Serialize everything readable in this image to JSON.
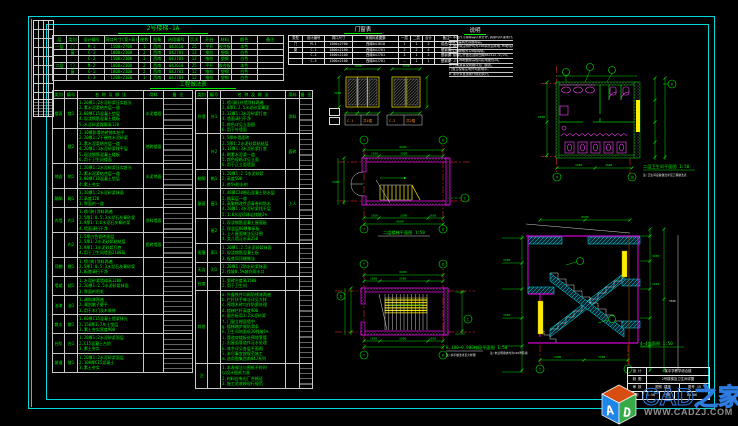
{
  "titles": {
    "schedule": "2号楼梯-1A",
    "materials": "工程做法表",
    "door_window": "门窗表",
    "notes": "说明"
  },
  "labels": {
    "plan1": "二层楼梯平面图 1:50",
    "stair_plan": "8.100~9.900梯段平面图 1:50",
    "stair_plan_note": "注:扶手做法详见大样图",
    "toilet": "二层卫生间平面图 1:50",
    "toilet_note": "注:卫生间设备做法详见工程做法表",
    "section": "4—4剖面图 1:50",
    "section_note": "注:未注明墙体均为240厚砖墙"
  },
  "dims": {
    "a": "6600",
    "b": "3300",
    "c": "1650",
    "d": "1800",
    "e": "1500",
    "f": "2100",
    "g": "1:50",
    "h": "900"
  },
  "bubbles": {
    "n7": "7",
    "n8": "8",
    "n9": "9",
    "n10": "10",
    "c": "C",
    "d": "D",
    "e": "E"
  },
  "schedule_table": {
    "headers": [
      "层",
      "类别",
      "设计编号",
      "洞口尺寸(宽×高)",
      "樘数",
      "图集",
      "选用编号",
      "页次",
      "开启",
      "材料",
      "颜色",
      "备注"
    ],
    "rows": [
      [
        "一层",
        "门",
        "M-1",
        "1500×2700",
        "1",
        "西南",
        "04J610",
        "25",
        "平开",
        "胶合板",
        "本色",
        ""
      ],
      [
        "",
        "窗",
        "C-1",
        "1800×2100",
        "2",
        "西南",
        "04J701",
        "12",
        "推拉",
        "塑钢",
        "白色",
        ""
      ],
      [
        "",
        "",
        "C-2",
        "1500×2100",
        "1",
        "西南",
        "04J701",
        "12",
        "推拉",
        "塑钢",
        "白色",
        ""
      ],
      [
        "二层",
        "门",
        "M-2",
        "1000×2100",
        "2",
        "西南",
        "04J610",
        "25",
        "平开",
        "胶合板",
        "本色",
        ""
      ],
      [
        "",
        "窗",
        "C-1",
        "1800×2100",
        "2",
        "西南",
        "04J701",
        "12",
        "推拉",
        "塑钢",
        "白色",
        ""
      ],
      [
        "",
        "",
        "C-3",
        "1200×2100",
        "1",
        "西南",
        "04J701",
        "12",
        "推拉",
        "塑钢",
        "白色",
        ""
      ]
    ]
  },
  "door_window_table": {
    "headers": [
      "类型",
      "设计编号",
      "洞口尺寸",
      "采用标准图集",
      "一层",
      "二层",
      "合计",
      "备注"
    ],
    "rows": [
      [
        "门",
        "M-1",
        "1500×2700",
        "西南04J610",
        "1",
        "1",
        "2",
        "成品门"
      ],
      [
        "窗",
        "C-1",
        "1800×2100",
        "西南04J701",
        "2",
        "2",
        "4",
        "塑钢窗"
      ],
      [
        "",
        "C-2",
        "1500×2100",
        "西南04J701",
        "1",
        "1",
        "2",
        "塑钢窗"
      ],
      [
        "",
        "C-3",
        "1200×2100",
        "西南04J701",
        "—",
        "1",
        "1",
        "塑钢窗"
      ]
    ]
  },
  "notes": {
    "lines": [
      "1.本图尺寸除标高以米计外,其余均以毫米计。",
      "  标高为建筑完成面标高。",
      "2.墙身除注明外均为240厚页岩砖墙,M5砂浆砌筑。",
      "  卫生间隔墙为120厚砖墙。",
      "3.楼梯栏杆做法选用西南04J412-①/25。",
      "4.卫生间地面标高较同层地面低20。",
      "5.门窗数量及规格详见门窗表。",
      "  门窗立樘除注明外均居墙中。",
      "6.未尽事宜按现行规范执行。"
    ]
  },
  "materials_a": {
    "headers": [
      "类别",
      "编号",
      "名 称 及 做 法",
      "用料",
      "备 注"
    ],
    "groups": [
      {
        "cat": "楼面",
        "code": "楼1",
        "lines": [
          "1.20厚1:2水泥砂浆压实赶光",
          "2.素水泥浆结合层一道",
          "3.60厚C15混凝土垫层",
          "4.现浇钢筋混凝土楼板",
          "5.水泥砂浆踢脚高120"
        ],
        "unit": "水泥楼面"
      },
      {
        "cat": "",
        "code": "楼2",
        "lines": [
          "1.10厚防滑地砖铺实拍平",
          "2.20厚1:2干硬性水泥砂浆",
          "3.素水泥浆结合层一道",
          "4.20厚1:3水泥砂浆找平层",
          "5.现浇钢筋混凝土楼板",
          "6.用于卫生间楼面"
        ],
        "unit": "地砖楼面"
      },
      {
        "cat": "地面",
        "code": "地1",
        "lines": [
          "1.20厚1:2水泥砂浆压实赶光",
          "2.素水泥浆结合层一道",
          "3.80厚C10混凝土垫层",
          "4.素土夯实"
        ],
        "unit": "水泥地面"
      },
      {
        "cat": "踢脚",
        "code": "踢1",
        "lines": [
          "1.20厚1:2水泥砂浆抹面",
          "2.高度120",
          "3.界面剂一道"
        ],
        "unit": ""
      },
      {
        "cat": "内墙",
        "code": "内1",
        "lines": [
          "1.喷(刷)涂料两遍",
          "2.5厚1:0.5:3水泥石灰膏砂浆",
          "3.9厚1:1:6水泥石灰膏砂浆",
          "4.墙面清扫干净"
        ],
        "unit": "涂料墙面"
      },
      {
        "cat": "",
        "code": "内2",
        "lines": [
          "1.5厚白色瓷砖面层",
          "2.5厚1:2水泥砂浆粘结层",
          "3.9厚1:3水泥砂浆打底",
          "4.用于卫生间墙面2100高"
        ],
        "unit": "瓷砖墙面"
      },
      {
        "cat": "顶棚",
        "code": "棚1",
        "lines": [
          "1.喷(刷)涂料两遍",
          "2.5厚1:0.5:3水泥石灰膏砂浆",
          "3.板底清扫干净"
        ],
        "unit": ""
      },
      {
        "cat": "墙裙",
        "code": "裙1",
        "lines": [
          "1.水泥砂浆墙裙高1200",
          "2.20厚1:2.5水泥砂浆抹面",
          "3.界面剂甩毛"
        ],
        "unit": ""
      },
      {
        "cat": "油漆",
        "code": "油1",
        "lines": [
          "1.调和漆两遍",
          "2.满刮腻子磨平",
          "3.用于木门及木装修"
        ],
        "unit": ""
      },
      {
        "cat": "散水",
        "code": "散1",
        "lines": [
          "1.60厚C15混凝土提浆抹光",
          "2.150厚3:7灰土垫层",
          "3.素土夯实宽度900"
        ],
        "unit": ""
      },
      {
        "cat": "台阶",
        "code": "台1",
        "lines": [
          "1.20厚1:2水泥砂浆面层",
          "2.C15混凝土台阶",
          "3.素土夯实"
        ],
        "unit": ""
      },
      {
        "cat": "坡道",
        "code": "坡1",
        "lines": [
          "1.20厚1:2水泥砂浆面层",
          "2.100厚C15混凝土",
          "3.素土夯实"
        ],
        "unit": ""
      }
    ]
  },
  "materials_b": {
    "headers": [
      "类别",
      "编号",
      "名 称 及 做 法",
      "用料",
      "备 注"
    ],
    "groups": [
      {
        "cat": "外墙",
        "code": "外1",
        "lines": [
          "1.喷(刷)外墙涂料两遍",
          "2.6厚1:2.5水泥砂浆罩面",
          "3.12厚1:3水泥砂浆打底",
          "4.墙面清扫干净",
          "5.颜色详见立面图",
          "6.用于外墙面"
        ],
        "unit": "涂料"
      },
      {
        "cat": "",
        "code": "外2",
        "lines": [
          "1.5厚外墙面砖",
          "2.5厚1:2水泥砂浆粘结层",
          "3.12厚1:3水泥砂浆打底",
          "4.刷素水泥浆一道",
          "5.颜色规格详见立面",
          "6.用于正立面墙面"
        ],
        "unit": "面砖"
      },
      {
        "cat": "勒脚",
        "code": "勒1",
        "lines": [
          "1.20厚1:2.5水泥砂浆",
          "2.高度500",
          "3.掺5%防水剂"
        ],
        "unit": ""
      },
      {
        "cat": "屋面",
        "code": "屋1",
        "lines": [
          "1.40厚C20细石混凝土防水层",
          "2.隔离层一道",
          "3.高聚物改性沥青卷材防水",
          "4.20厚1:3水泥砂浆找平层",
          "5.1:8水泥珍珠岩找坡2%"
        ],
        "unit": "上人"
      },
      {
        "cat": "",
        "code": "屋2",
        "lines": [
          "1.现浇钢筋混凝土屋面板",
          "2.保温层80厚聚苯板",
          "3.上人屋面做法见详图",
          "4.女儿墙泛水高250"
        ],
        "unit": ""
      },
      {
        "cat": "雨篷",
        "code": "雨1",
        "lines": [
          "1.20厚1:2.5水泥砂浆抹面",
          "2.现浇钢筋混凝土板",
          "3.板底同顶棚做法"
        ],
        "unit": ""
      },
      {
        "cat": "天沟",
        "code": "沟1",
        "lines": [
          "1.20厚1:2防水砂浆抹面",
          "2.找坡0.5%坡向雨水口"
        ],
        "unit": ""
      },
      {
        "cat": "台度",
        "code": "",
        "lines": [
          "1.瓷砖台度高1500",
          "2.用于卫生间"
        ],
        "unit": ""
      },
      {
        "cat": "其他",
        "code": "",
        "lines": [
          "a.外露铁件均刷防锈漆两遍",
          "b.栏杆扶手做法详见大样",
          "c.预埋木砖均作防腐处理",
          "d.楼梯栏杆高度900",
          "e.窗台板用1:2水泥砂浆",
          "f.门窗立樘居墙中",
          "g.楼梯踏步做防滑条",
          "h.卫生间地面低20找坡1%",
          "i.管道穿楼板处预埋套管",
          "j.出屋面管道作泛水处理",
          "k.其余详见各层平面图",
          "l.未尽事宜按规范施工",
          "m.选用图集西南04J系列"
        ],
        "unit": ""
      },
      {
        "cat": "注",
        "code": "",
        "lines": [
          "1.本表做法与图纸不符时",
          "  以设计图纸为准",
          "2.材料应有出厂合格证",
          "3.施工验收按现行规范"
        ],
        "unit": ""
      }
    ]
  },
  "window_details": {
    "t1a": "C-1",
    "t1b": "共4樘",
    "t2a": "C-2",
    "t2b": "共2樘"
  },
  "titleblock": {
    "r1l": "设 计",
    "r1r": "某中学教学综合楼",
    "r2l": "制 图",
    "r2r": "2号楼梯及卫生间详图",
    "r3l": "审 核",
    "r3m": "图别 建施",
    "r3r": "图号 15",
    "r4a": "比例",
    "r4b": "1:50",
    "r4c": "日期",
    "r4d": "04.06"
  },
  "watermark": {
    "brand": "CAD之家",
    "url": "WWW.CADZJ.COM",
    "logo_a": "A",
    "logo_d": "D"
  }
}
